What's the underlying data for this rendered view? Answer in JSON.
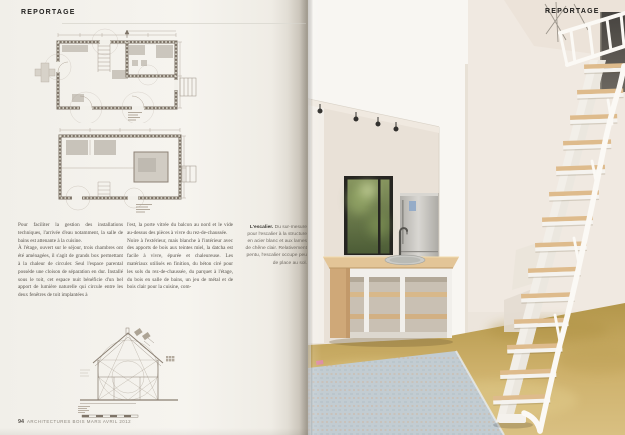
{
  "magazine": {
    "section_left": "REPORTAGE",
    "section_right": "REPORTAGE",
    "footer_page_number": "94",
    "footer_title": "ARCHITECTURES BOIS MARS AVRIL 2012"
  },
  "article": {
    "columns": [
      {
        "paragraphs": [
          "Pour faciliter la gestion des installations techniques, l'arrivée d'eau notamment, la salle de bains est attenante à la cuisine.",
          "À l'étage, ouvert sur le séjour, trois chambres ont été aménagées, il s'agit de grands box permettant à la chaleur de circuler. Seul l'espace parental possède une cloison de séparation en dur. Installé sous le toit, cet espace nuit bénéficie d'un bel apport de lumière naturelle qui circule entre les deux fenêtres de toit implantées à"
        ]
      },
      {
        "paragraphs": [
          "l'est, la porte vitrée du balcon au nord et le vide au-dessus des pièces à vivre du rez-de-chaussée.",
          "Noire à l'extérieur, mais blanche à l'intérieur avec des apports de bois aux teintes miel, la datcha est facile à vivre, épurée et chaleureuse. Les matériaux utilisés en finition, du béton ciré pour les sols du rez-de-chaussée, du parquet à l'étage, du bois en salle de bains, un jeu de métal et de bois clair pour la cuisine, com-"
        ]
      }
    ],
    "caption": {
      "title": "L'escalier.",
      "body": " Du sur-mesure pour l'escalier à la structure en acier blanc et aux lames de chêne clair. Relativement pentu, l'escalier occupe peu de place au sol."
    }
  },
  "figures": {
    "ground_floor_plan": "plan du rez-de-chaussée",
    "upper_floor_plan": "plan de l'étage",
    "cross_section": "coupe transversale",
    "photo": "escalier en acier blanc et chêne clair devant la cuisine"
  },
  "photo": {
    "stair_step_count": 14
  },
  "colors": {
    "paper": "#f4f2ed",
    "ink": "#57524b",
    "plan_line": "#7e7468",
    "wood": "#debb8c",
    "steel_white": "#fbf9f5",
    "floor_ochre": "#c9a85f",
    "rug_blue": "#c2ccd2",
    "window_green": "#7f8d5a"
  }
}
